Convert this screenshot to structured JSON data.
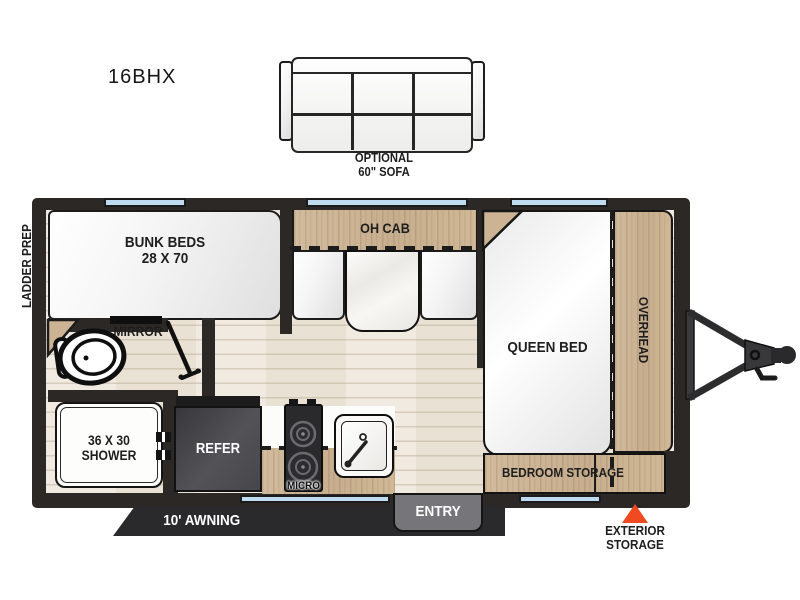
{
  "model": "16BHX",
  "sofa": {
    "label_line1": "OPTIONAL",
    "label_line2": "60\" SOFA"
  },
  "floorplan": {
    "ladder_prep": "LADDER PREP",
    "bunk_beds": {
      "line1": "BUNK BEDS",
      "line2": "28 X 70"
    },
    "mirror": "MIRROR",
    "oh_cab": "OH CAB",
    "queen_bed": "QUEEN BED",
    "overhead": "OVERHEAD",
    "bedroom_storage": "BEDROOM STORAGE",
    "shower": {
      "line1": "36 X 30",
      "line2": "SHOWER"
    },
    "refer": "REFER",
    "micro": "MICRO",
    "entry": "ENTRY",
    "awning": "10' AWNING",
    "exterior_storage": {
      "line1": "EXTERIOR",
      "line2": "STORAGE"
    }
  },
  "colors": {
    "wall": "#2b2826",
    "wood": "#ccb394",
    "floor": "#e9e1d3",
    "window_blue": "#bedbf0",
    "accent_orange": "#ef4a22",
    "furniture_white": "#fdfdfd",
    "refer_gray": "#4a4a4e"
  }
}
